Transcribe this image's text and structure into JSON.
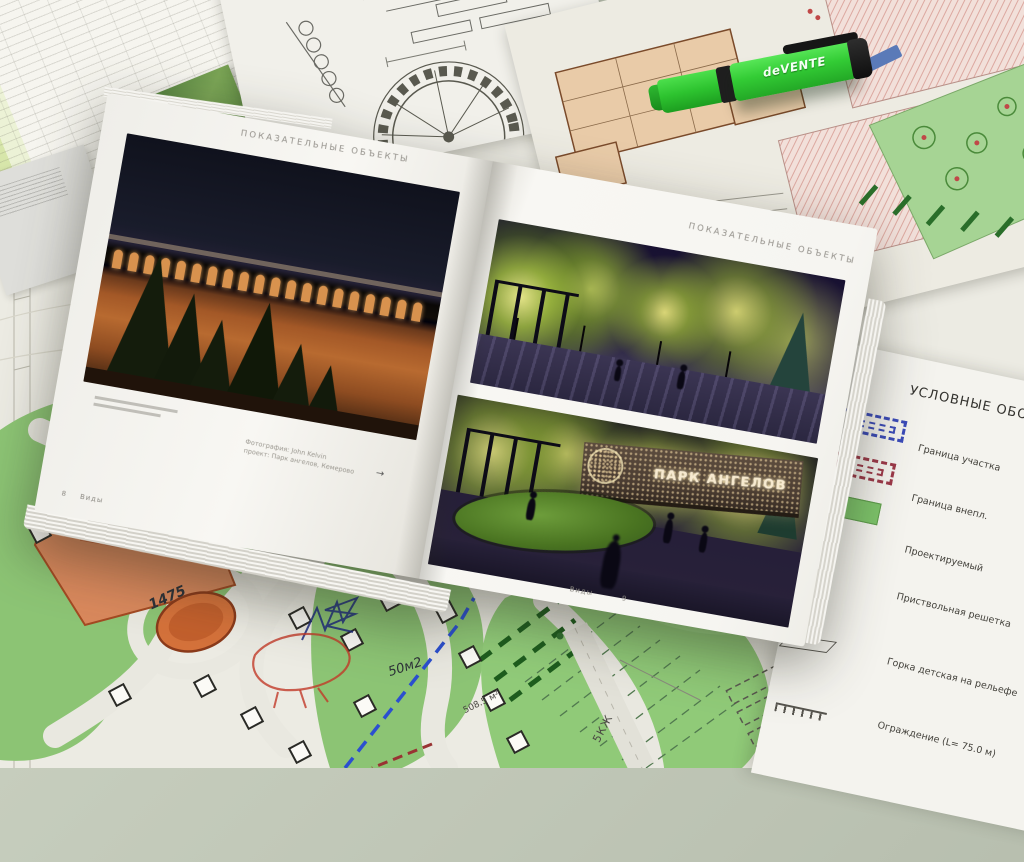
{
  "book": {
    "left_page": {
      "header": "ПОКАЗАТЕЛЬНЫЕ ОБЪЕКТЫ",
      "caption_line1": "Фотография: John Kelvin",
      "caption_line2": "проект: Парк ангелов, Кемерово",
      "arrow_glyph": "→",
      "footer_page": "8",
      "footer_label": "Виды"
    },
    "right_page": {
      "header": "ПОКАЗАТЕЛЬНЫЕ ОБЪЕКТЫ",
      "photo_sign_text": "ПАРК АНГЕЛОВ",
      "footer_label": "Виды",
      "footer_page": "9"
    }
  },
  "highlighter": {
    "brand": "deVENTE"
  },
  "legend": {
    "title": "УСЛОВНЫЕ ОБОЗНАЧЕНИЯ",
    "items": [
      {
        "symbol": "blue-dashed-boundary",
        "label": "Граница участка"
      },
      {
        "symbol": "red-dashed-boundary",
        "label": "Граница внепл."
      },
      {
        "symbol": "green-area-fill",
        "label": "Проектируемый"
      },
      {
        "symbol": "tree-grate-square",
        "label": "Приствольная решетка"
      },
      {
        "symbol": "slide-ramp",
        "label": "Горка детская на рельефе"
      },
      {
        "symbol": "fence-line",
        "label": "Ограждение (L= 75.0 м)"
      }
    ]
  },
  "plan": {
    "annotations": {
      "handwritten_number": "1475",
      "handwritten_area": "50м2",
      "printed_area": "508.5 м²",
      "building_label": "5КЖ"
    }
  },
  "colors": {
    "highlighter_green": "#33cc35",
    "plan_lawn_green": "#8cc474",
    "plan_building_orange": "#d4713a",
    "legend_boundary_blue": "#3a4ab8",
    "legend_boundary_red": "#9c3848",
    "night_sky": "#181131",
    "book_page": "#f6f5f1"
  }
}
